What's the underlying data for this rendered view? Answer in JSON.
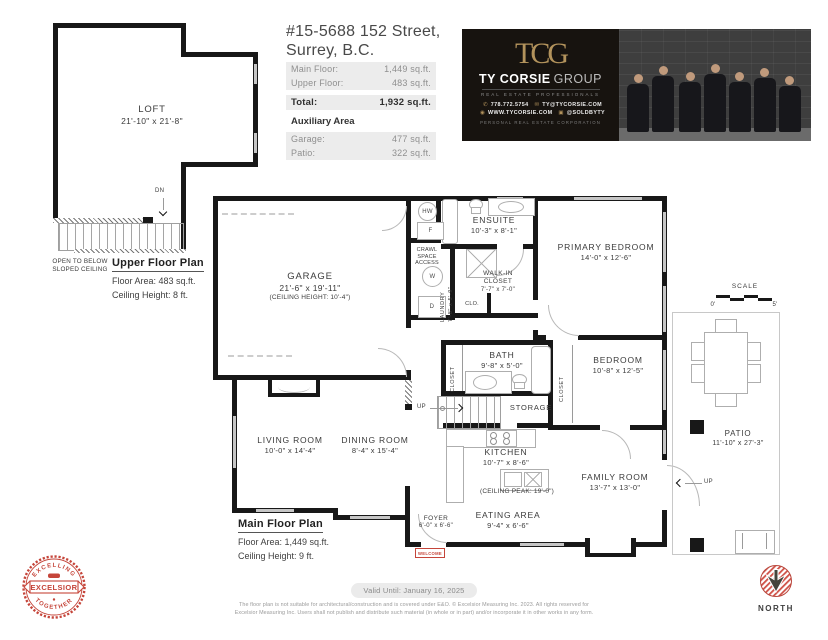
{
  "colors": {
    "wall": "#181818",
    "seal_red": "#c5453a",
    "welcome_red": "#c5453a",
    "banner_gold": "#b3935c",
    "banner_bg": "#17130f",
    "fact_row_bg": "#ececec"
  },
  "header": {
    "address_line1": "#15-5688 152 Street,",
    "address_line2": "Surrey, B.C.",
    "main_floor_label": "Main Floor:",
    "main_floor_value": "1,449 sq.ft.",
    "upper_floor_label": "Upper Floor:",
    "upper_floor_value": "483 sq.ft.",
    "total_label": "Total:",
    "total_value": "1,932 sq.ft.",
    "auxiliary_title": "Auxiliary Area",
    "garage_label": "Garage:",
    "garage_value": "477 sq.ft.",
    "patio_label": "Patio:",
    "patio_value": "322 sq.ft."
  },
  "banner": {
    "monogram": "TCG",
    "brand_name": "TY CORSIE",
    "brand_suffix": "GROUP",
    "tagline": "REAL ESTATE PROFESSIONALS",
    "phone": "778.772.5754",
    "email": "TY@TYCORSIE.COM",
    "website": "WWW.TYCORSIE.COM",
    "instagram": "@SOLDBYTY",
    "corporation": "PERSONAL REAL ESTATE CORPORATION",
    "icons": {
      "phone": "✆",
      "email": "✉",
      "website": "◉",
      "instagram": "▣"
    }
  },
  "upper_plan": {
    "title": "Upper Floor Plan",
    "floor_area": "Floor Area: 483 sq.ft.",
    "ceiling_height": "Ceiling Height: 8 ft.",
    "stairs_label": "DN",
    "open_to_below_line1": "OPEN TO BELOW",
    "open_to_below_line2": "SLOPED CEILING",
    "rooms": {
      "loft": {
        "name": "LOFT",
        "dims": "21'-10\" x 21'-8\""
      }
    }
  },
  "main_plan": {
    "title": "Main Floor Plan",
    "floor_area": "Floor Area: 1,449 sq.ft.",
    "ceiling_height": "Ceiling Height: 9 ft.",
    "stairs_label": "UP",
    "welcome_mat": "WELCOME",
    "rooms": {
      "garage": {
        "name": "GARAGE",
        "dims": "21'-6\" x 19'-11\"",
        "note": "(CEILING HEIGHT: 10'-4\")"
      },
      "ensuite": {
        "name": "ENSUITE",
        "dims": "10'-3\" x 8'-1\""
      },
      "primary_bedroom": {
        "name": "PRIMARY BEDROOM",
        "dims": "14'-0\" x 12'-6\""
      },
      "walk_in_closet": {
        "name": "WALK-IN CLOSET",
        "dims": "7'-7\" x 7'-0\""
      },
      "laundry": {
        "name": "LAUNDRY",
        "dims": "7'-8\" x 5'-9\""
      },
      "bath": {
        "name": "BATH",
        "dims": "9'-8\" x 5'-0\""
      },
      "bedroom": {
        "name": "BEDROOM",
        "dims": "10'-8\" x 12'-5\""
      },
      "storage": {
        "name": "STORAGE"
      },
      "living_room": {
        "name": "LIVING ROOM",
        "dims": "10'-0\" x 14'-4\""
      },
      "dining_room": {
        "name": "DINING ROOM",
        "dims": "8'-4\" x 15'-4\""
      },
      "kitchen": {
        "name": "KITCHEN",
        "dims": "10'-7\" x 8'-6\"",
        "note": "(CEILING PEAK: 19'-0\")"
      },
      "family_room": {
        "name": "FAMILY ROOM",
        "dims": "13'-7\" x 13'-0\""
      },
      "eating_area": {
        "name": "EATING AREA",
        "dims": "9'-4\" x 6'-6\""
      },
      "foyer": {
        "name": "FOYER",
        "dims": "6'-0\" x 6'-6\""
      },
      "patio": {
        "name": "PATIO",
        "dims": "11'-10\" x 27'-3\""
      }
    },
    "labels": {
      "hw": "HW",
      "furnace": "F",
      "washer": "W",
      "dryer": "D",
      "crawl_line1": "CRAWL",
      "crawl_line2": "SPACE",
      "crawl_line3": "ACCESS",
      "clo": "CLO.",
      "closet": "CLOSET"
    }
  },
  "scale_bar": {
    "label": "SCALE",
    "start": "0'",
    "end": "5'"
  },
  "footer": {
    "valid_until": "Valid Until: January 16, 2025",
    "disclaimer_line1": "The floor plan is not suitable for architectural/construction and is covered under E&O. © Excelsior Measuring Inc. 2023. All rights reserved for",
    "disclaimer_line2": "Excelsior Measuring Inc. Users shall not publish and distribute such material (in whole or in part) and/or incorporate it in other works in any form.",
    "north_label": "NORTH",
    "seal": {
      "arc_top": "EXCELLING",
      "banner": "EXCELSIOR",
      "arc_bottom": "TOGETHER"
    }
  }
}
